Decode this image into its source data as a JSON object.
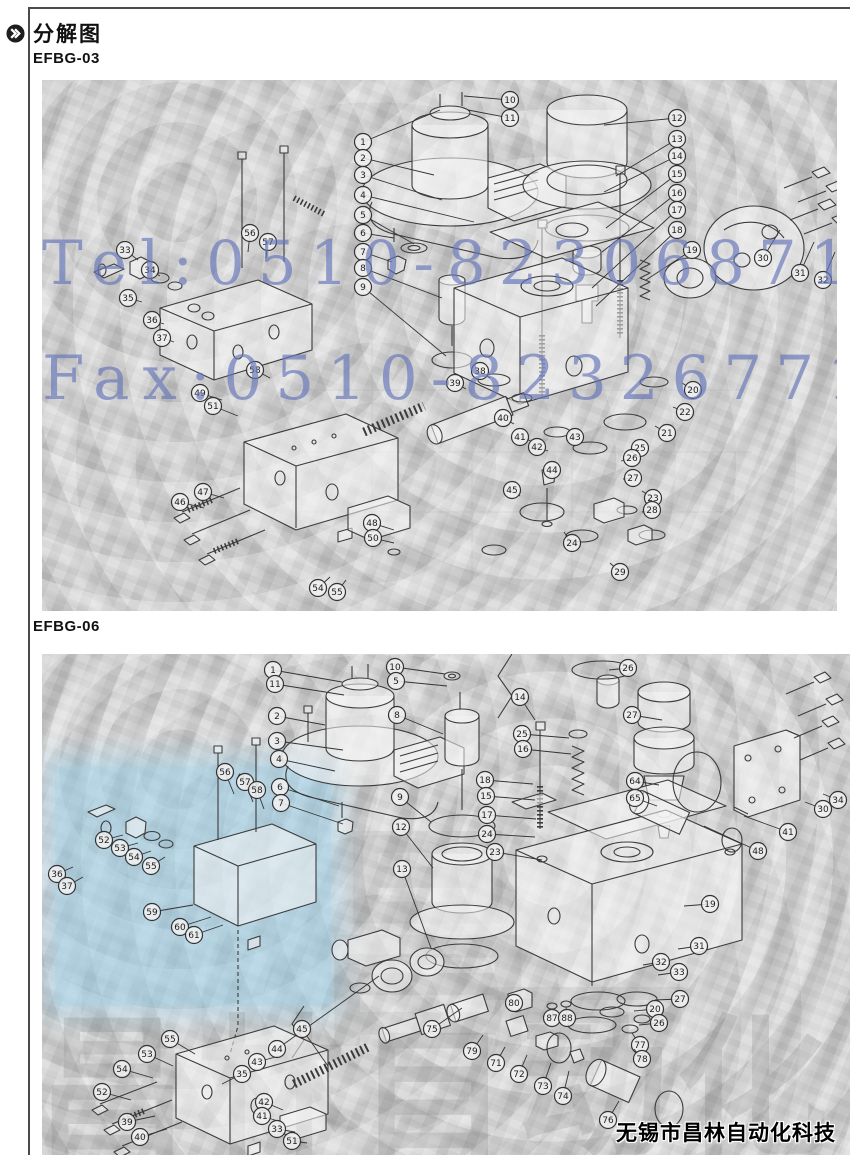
{
  "page": {
    "title": "分解图"
  },
  "sections": [
    {
      "label": "EFBG-03"
    },
    {
      "label": "EFBG-06"
    }
  ],
  "watermark": {
    "tel": "Tel:0510-82306871",
    "fax": "Fax:0510-82326771",
    "color": "#6978b9"
  },
  "ghost_text": "昌林自动化",
  "ghost_char": "昌",
  "footer": {
    "company": "无锡市昌林自动化科技"
  },
  "colors": {
    "paper": "#cbcbcb",
    "line_art": "#3b3b3b",
    "blue_patch": "#94cee9"
  },
  "diagrams": [
    {
      "id": "svg-d1",
      "model": "EFBG-03",
      "callouts": [
        [
          1,
          321,
          62,
          398,
          30
        ],
        [
          2,
          321,
          78,
          392,
          95
        ],
        [
          3,
          321,
          95,
          400,
          120
        ],
        [
          4,
          321,
          115,
          432,
          142
        ],
        [
          5,
          321,
          135,
          372,
          164
        ],
        [
          6,
          321,
          153,
          352,
          158
        ],
        [
          7,
          321,
          172,
          350,
          182
        ],
        [
          8,
          321,
          188,
          400,
          218
        ],
        [
          9,
          321,
          207,
          404,
          276
        ],
        [
          10,
          468,
          20,
          422,
          16
        ],
        [
          11,
          468,
          38,
          426,
          30
        ],
        [
          12,
          635,
          38,
          562,
          45
        ],
        [
          13,
          635,
          59,
          574,
          96
        ],
        [
          14,
          635,
          76,
          562,
          112
        ],
        [
          15,
          635,
          94,
          564,
          148
        ],
        [
          16,
          635,
          113,
          560,
          172
        ],
        [
          17,
          635,
          130,
          550,
          208
        ],
        [
          18,
          635,
          150,
          554,
          226
        ],
        [
          19,
          650,
          170,
          604,
          200
        ],
        [
          30,
          721,
          178,
          738,
          150
        ],
        [
          31,
          758,
          193,
          772,
          162
        ],
        [
          32,
          781,
          200,
          793,
          172
        ],
        [
          33,
          83,
          170,
          96,
          180
        ],
        [
          34,
          108,
          190,
          118,
          196
        ],
        [
          35,
          86,
          218,
          100,
          222
        ],
        [
          36,
          110,
          240,
          122,
          244
        ],
        [
          37,
          120,
          258,
          132,
          262
        ],
        [
          56,
          208,
          153,
          206,
          172
        ],
        [
          57,
          226,
          162,
          224,
          178
        ],
        [
          58,
          213,
          290,
          228,
          298
        ],
        [
          49,
          158,
          313,
          180,
          320
        ],
        [
          51,
          171,
          326,
          196,
          336
        ],
        [
          46,
          138,
          422,
          162,
          428
        ],
        [
          47,
          161,
          412,
          182,
          418
        ],
        [
          48,
          330,
          443,
          352,
          450
        ],
        [
          50,
          331,
          458,
          352,
          463
        ],
        [
          54,
          276,
          508,
          288,
          497
        ],
        [
          55,
          295,
          512,
          304,
          500
        ],
        [
          20,
          651,
          310,
          640,
          303
        ],
        [
          21,
          625,
          353,
          613,
          346
        ],
        [
          22,
          643,
          332,
          631,
          327
        ],
        [
          23,
          611,
          418,
          600,
          411
        ],
        [
          24,
          530,
          463,
          522,
          452
        ],
        [
          25,
          598,
          368,
          588,
          372
        ],
        [
          26,
          590,
          378,
          579,
          381
        ],
        [
          27,
          591,
          398,
          581,
          399
        ],
        [
          28,
          610,
          430,
          600,
          432
        ],
        [
          29,
          578,
          492,
          568,
          483
        ],
        [
          38,
          438,
          291,
          448,
          298
        ],
        [
          39,
          413,
          303,
          424,
          309
        ],
        [
          40,
          461,
          338,
          472,
          344
        ],
        [
          41,
          478,
          357,
          489,
          361
        ],
        [
          42,
          495,
          367,
          506,
          371
        ],
        [
          43,
          533,
          357,
          525,
          361
        ],
        [
          44,
          510,
          390,
          506,
          398
        ],
        [
          45,
          470,
          410,
          478,
          416
        ]
      ]
    },
    {
      "id": "svg-d2",
      "model": "EFBG-06",
      "callouts": [
        [
          1,
          231,
          16,
          300,
          28
        ],
        [
          11,
          233,
          30,
          302,
          41
        ],
        [
          2,
          235,
          62,
          283,
          71
        ],
        [
          3,
          235,
          87,
          301,
          96
        ],
        [
          4,
          237,
          105,
          293,
          117
        ],
        [
          6,
          238,
          133,
          297,
          152
        ],
        [
          7,
          239,
          149,
          301,
          170
        ],
        [
          10,
          353,
          13,
          403,
          20
        ],
        [
          5,
          354,
          27,
          405,
          32
        ],
        [
          8,
          355,
          61,
          401,
          80
        ],
        [
          9,
          358,
          143,
          389,
          168
        ],
        [
          12,
          359,
          173,
          391,
          214
        ],
        [
          13,
          360,
          215,
          389,
          294
        ],
        [
          14,
          478,
          43,
          493,
          66
        ],
        [
          25,
          480,
          80,
          527,
          84
        ],
        [
          16,
          481,
          95,
          529,
          100
        ],
        [
          18,
          443,
          126,
          491,
          130
        ],
        [
          15,
          444,
          142,
          493,
          146
        ],
        [
          17,
          445,
          161,
          494,
          165
        ],
        [
          24,
          445,
          180,
          493,
          183
        ],
        [
          23,
          453,
          198,
          500,
          206
        ],
        [
          26,
          586,
          14,
          567,
          16
        ],
        [
          27,
          590,
          61,
          620,
          66
        ],
        [
          64,
          593,
          127,
          617,
          131
        ],
        [
          65,
          593,
          144,
          615,
          152
        ],
        [
          19,
          668,
          250,
          642,
          252
        ],
        [
          31,
          657,
          292,
          636,
          295
        ],
        [
          32,
          619,
          308,
          601,
          311
        ],
        [
          33,
          637,
          318,
          616,
          321
        ],
        [
          27,
          638,
          345,
          613,
          346
        ],
        [
          20,
          613,
          355,
          592,
          357
        ],
        [
          26,
          617,
          369,
          597,
          371
        ],
        [
          34,
          796,
          146,
          781,
          140
        ],
        [
          30,
          781,
          155,
          763,
          148
        ],
        [
          41,
          746,
          178,
          702,
          162
        ],
        [
          48,
          716,
          197,
          662,
          172
        ],
        [
          56,
          183,
          118,
          192,
          140
        ],
        [
          57,
          203,
          128,
          211,
          148
        ],
        [
          58,
          215,
          136,
          222,
          155
        ],
        [
          52,
          62,
          186,
          81,
          181
        ],
        [
          53,
          78,
          194,
          96,
          189
        ],
        [
          54,
          92,
          203,
          109,
          197
        ],
        [
          55,
          109,
          212,
          123,
          203
        ],
        [
          36,
          15,
          220,
          31,
          213
        ],
        [
          37,
          25,
          232,
          41,
          223
        ],
        [
          59,
          110,
          258,
          151,
          251
        ],
        [
          60,
          138,
          273,
          169,
          263
        ],
        [
          61,
          152,
          281,
          181,
          271
        ],
        [
          55,
          128,
          385,
          153,
          400
        ],
        [
          53,
          105,
          400,
          131,
          412
        ],
        [
          54,
          80,
          415,
          111,
          424
        ],
        [
          52,
          60,
          438,
          89,
          446
        ],
        [
          39,
          85,
          468,
          113,
          462
        ],
        [
          40,
          98,
          483,
          125,
          475
        ],
        [
          35,
          200,
          420,
          180,
          430
        ],
        [
          43,
          215,
          408,
          241,
          401
        ],
        [
          44,
          235,
          395,
          337,
          322
        ],
        [
          45,
          260,
          375,
          286,
          412
        ],
        [
          42,
          222,
          448,
          241,
          456
        ],
        [
          41,
          220,
          462,
          239,
          468
        ],
        [
          33,
          235,
          475,
          253,
          478
        ],
        [
          51,
          250,
          487,
          265,
          489
        ],
        [
          75,
          390,
          375,
          420,
          354
        ],
        [
          80,
          472,
          349,
          479,
          344
        ],
        [
          87,
          510,
          364,
          511,
          355
        ],
        [
          88,
          525,
          364,
          524,
          353
        ],
        [
          79,
          430,
          397,
          441,
          381
        ],
        [
          71,
          454,
          409,
          463,
          393
        ],
        [
          72,
          477,
          420,
          485,
          401
        ],
        [
          73,
          501,
          432,
          509,
          409
        ],
        [
          74,
          521,
          442,
          527,
          417
        ],
        [
          76,
          566,
          466,
          577,
          447
        ],
        [
          77,
          598,
          391,
          590,
          379
        ],
        [
          78,
          600,
          405,
          592,
          395
        ]
      ]
    }
  ]
}
